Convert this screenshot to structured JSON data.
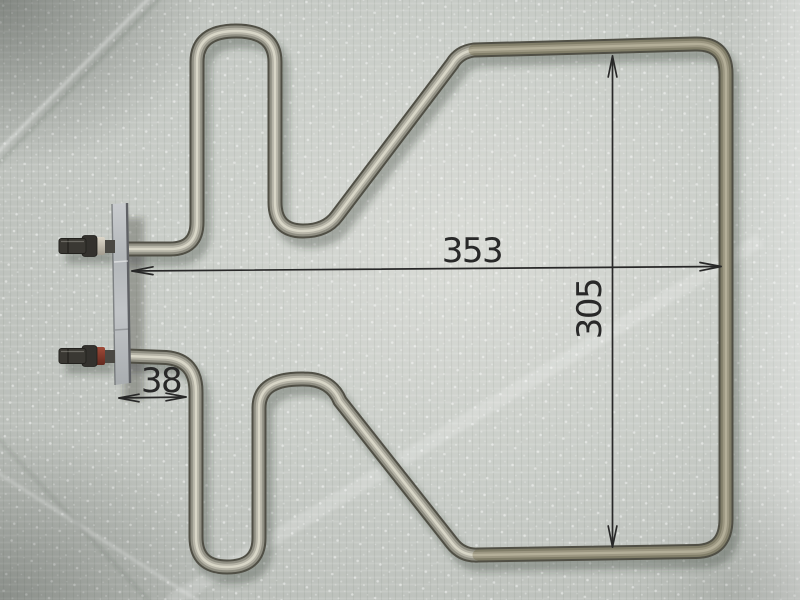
{
  "scene": {
    "subject": "Electric oven bake heating element with mounting plate and spade terminals, photographed on a woven tarpaulin, annotated with overall dimensions",
    "annotations": {
      "width_label": "353",
      "height_label": "305",
      "offset_label": "38"
    },
    "colors": {
      "background_base": "#c3c7c2",
      "tube_outline": "#504f45",
      "tube_body": "#8f8e82",
      "tube_light": "#b6b4a7",
      "tube_specular": "#dcd9cb",
      "annotation_ink": "#282828",
      "plate_face": "#b7bbbe",
      "plate_edge": "#5f6165",
      "terminal_metal": "#3a3833",
      "insulator_top": "#cfc9bc",
      "insulator_bottom": "#8a4131"
    }
  }
}
